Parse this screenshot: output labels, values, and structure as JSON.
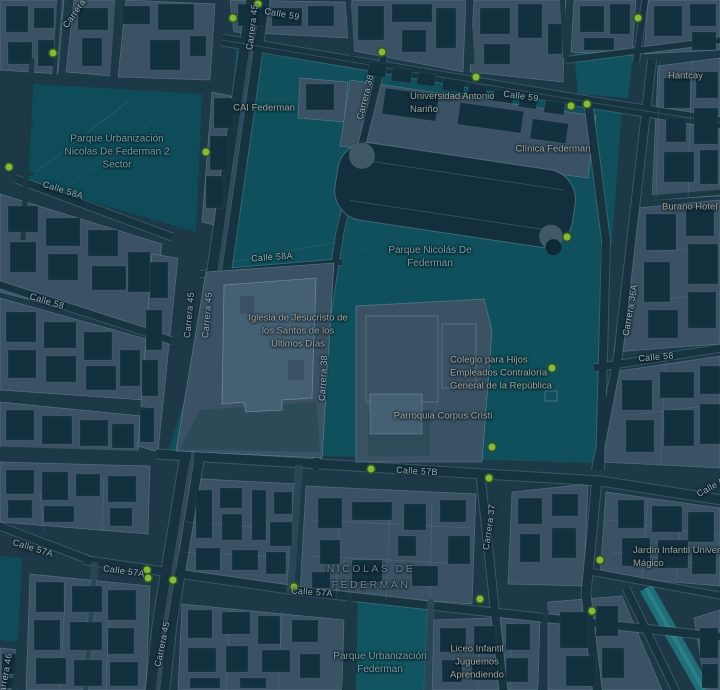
{
  "map": {
    "title": "Nicolás de Federmán – dark street map",
    "colors": {
      "background_streets": "#1d3947",
      "city_block": "#3a5264",
      "building_dark": "#13303f",
      "park_green": "#0f505c",
      "canal_teal": "#2a7f88",
      "road_casing": "#5d7f93",
      "street_label": "#9cb0ba",
      "park_label": "#7e9aa0",
      "poi_label": "#a2a59b",
      "marker_green": "#84ba3e"
    },
    "marker": {
      "name": "green-poi-dot",
      "fill": "#84ba3e",
      "stroke": "#33531f"
    },
    "street_labels": [
      "Carrera 45",
      "Calle 59",
      "Carrera 38",
      "Calle 59",
      "Carrera 45",
      "Carrera 45",
      "Carrera 38",
      "Calle 58A",
      "Calle 58A",
      "Calle 58",
      "Calle 57B",
      "Carrera 37",
      "Calle 57A",
      "Calle 57A",
      "Calle 57A",
      "Carrera 45",
      "Carrera 36A",
      "Calle 58",
      "Calle 56",
      "Carrera 46",
      "Carrera 46"
    ],
    "park_labels": [
      [
        "Parque Urbanización",
        "Nicolas De Federman 2",
        "Sector"
      ],
      [
        "Parque Nicolás De",
        "Federman"
      ],
      [
        "Parque Urbanización",
        "Federman"
      ]
    ],
    "poi_labels": [
      [
        "CAI Federman"
      ],
      [
        "Universidad Antonio",
        "Nariño"
      ],
      [
        "Clínica Federman"
      ],
      [
        "Iglesia de Jesucristo de",
        "los Santos de los",
        "Últimos Días"
      ],
      [
        "Colegio para Hijos",
        "Empleados Contraloría",
        "General de la República"
      ],
      [
        "Parroquia Corpus Cristi"
      ],
      [
        "Liceo Infantil",
        "Juguemos",
        "Aprendiendo"
      ],
      [
        "Jardín Infantil Universo",
        "Mágico"
      ],
      [
        "Burano Hotel"
      ],
      [
        "Hantcay"
      ]
    ],
    "neighborhood": [
      "NICOLAS DE",
      "FEDERMAN"
    ]
  }
}
